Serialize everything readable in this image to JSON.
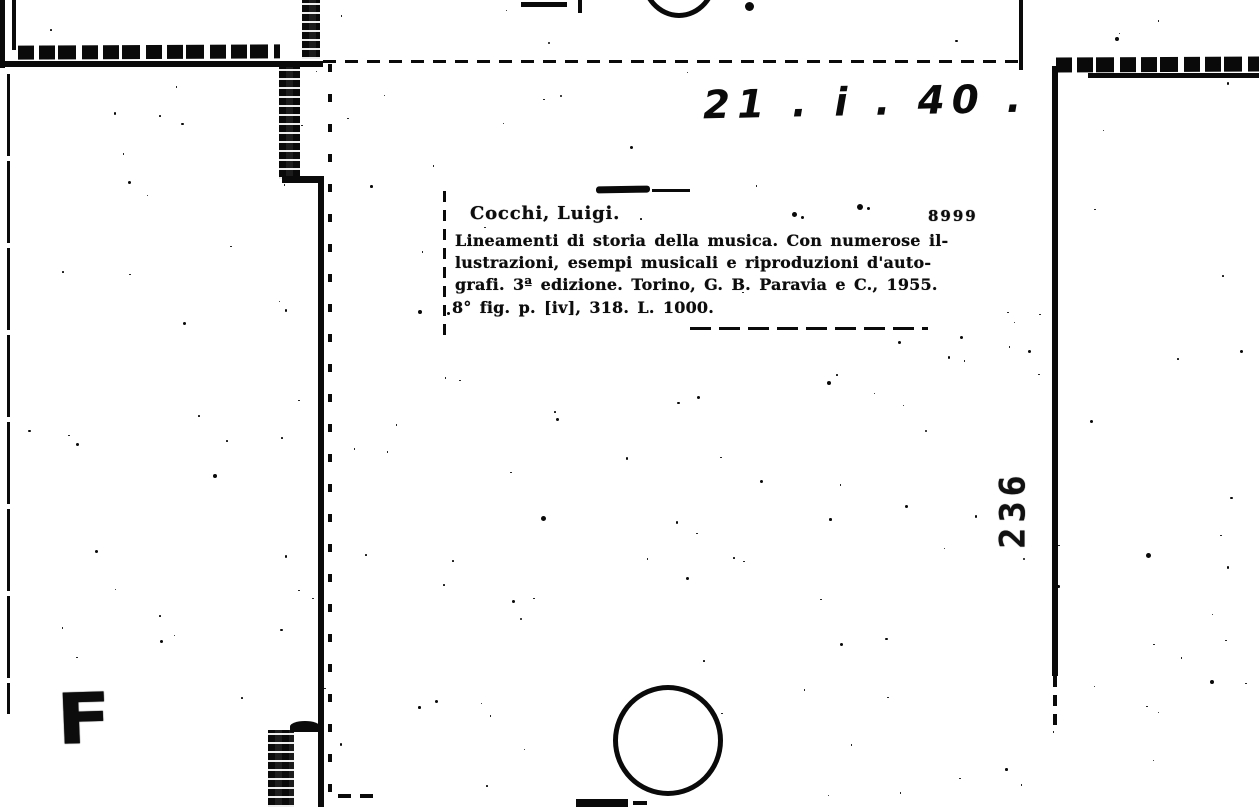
{
  "document": {
    "shelfmark": "21 . i . 40 .",
    "frame_number": "236",
    "stamp_letter": "F",
    "card": {
      "heading": "Cocchi, Luigi.",
      "entry_number": "8999",
      "body_lines": [
        "Lineamenti di storia della musica. Con numerose il-",
        "lustrazioni, esempi musicali e riproduzioni d'auto-",
        "grafi. 3ª edizione.  Torino, G. B. Paravia e C., 1955.",
        "8° fig.  p. [iv], 318.  L. 1000."
      ]
    },
    "colors": {
      "ink": "#0a0a0a",
      "paper": "#ffffff"
    }
  }
}
